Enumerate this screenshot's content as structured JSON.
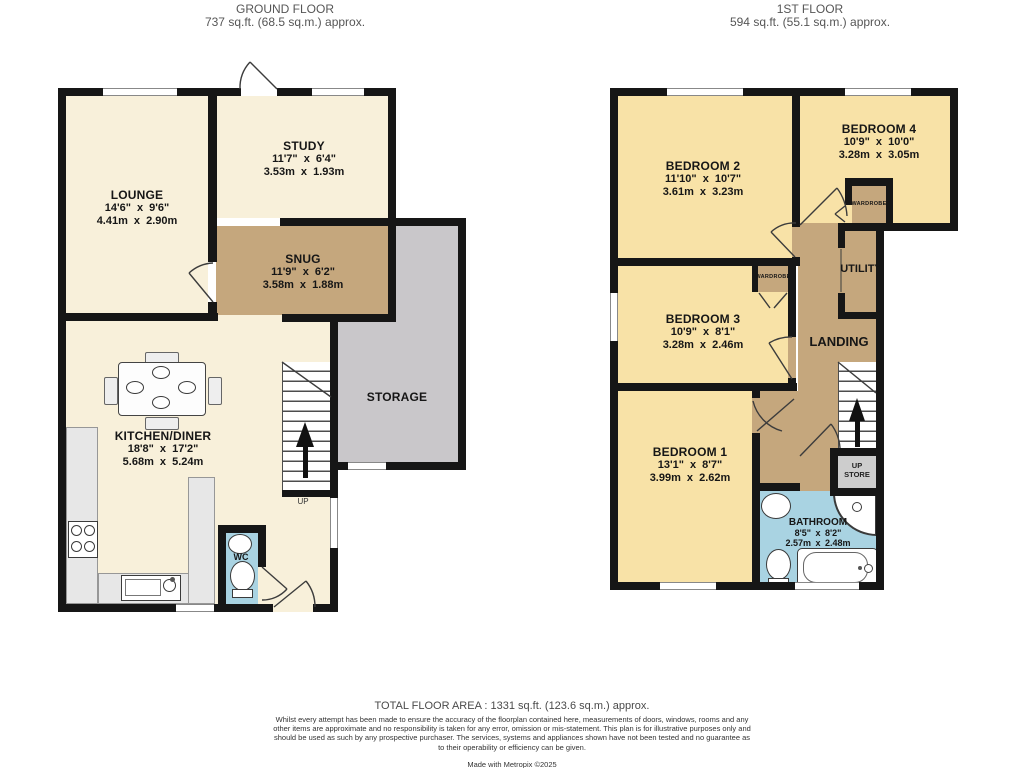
{
  "colors": {
    "wall": "#161616",
    "ground_room": "#f8f0da",
    "first_room": "#f8e2a7",
    "hallway": "#c5a77d",
    "storage": "#c9c7ca",
    "water": "#a9d3e2",
    "counter": "#e7e7e7",
    "store_box": "#cdcdcd"
  },
  "ground_floor": {
    "title": "GROUND FLOOR",
    "area": "737 sq.ft. (68.5 sq.m.) approx.",
    "rooms": {
      "lounge": {
        "name": "LOUNGE",
        "imperial": "14'6\" x 9'6\"",
        "metric": "4.41m x 2.90m"
      },
      "study": {
        "name": "STUDY",
        "imperial": "11'7\" x 6'4\"",
        "metric": "3.53m x 1.93m"
      },
      "snug": {
        "name": "SNUG",
        "imperial": "11'9\" x 6'2\"",
        "metric": "3.58m x 1.88m"
      },
      "kitchen_diner": {
        "name": "KITCHEN/DINER",
        "imperial": "18'8\" x 17'2\"",
        "metric": "5.68m x 5.24m"
      },
      "storage": {
        "name": "STORAGE"
      },
      "wc": {
        "name": "WC"
      }
    },
    "stairs_label": "UP"
  },
  "first_floor": {
    "title": "1ST FLOOR",
    "area": "594 sq.ft. (55.1 sq.m.) approx.",
    "rooms": {
      "bedroom_2": {
        "name": "BEDROOM 2",
        "imperial": "11'10\" x 10'7\"",
        "metric": "3.61m x 3.23m"
      },
      "bedroom_4": {
        "name": "BEDROOM 4",
        "imperial": "10'9\" x 10'0\"",
        "metric": "3.28m x 3.05m"
      },
      "bedroom_3": {
        "name": "BEDROOM 3",
        "imperial": "10'9\" x 8'1\"",
        "metric": "3.28m x 2.46m"
      },
      "bedroom_1": {
        "name": "BEDROOM 1",
        "imperial": "13'1\" x 8'7\"",
        "metric": "3.99m x 2.62m"
      },
      "bathroom": {
        "name": "BATHROOM",
        "imperial": "8'5\" x 8'2\"",
        "metric": "2.57m x 2.48m"
      },
      "landing": {
        "name": "LANDING"
      },
      "utility": {
        "name": "UTILITY"
      },
      "wardrobe_bedroom_4": {
        "name": "WARDROBE"
      },
      "wardrobe_bedroom_3": {
        "name": "WARDROBE"
      },
      "up_store": {
        "line1": "UP",
        "line2": "STORE"
      }
    }
  },
  "footer": {
    "total_area": "TOTAL FLOOR AREA : 1331 sq.ft. (123.6 sq.m.) approx.",
    "disclaimer": "Whilst every attempt has been made to ensure the accuracy of the floorplan contained here, measurements of doors, windows, rooms and any other items are approximate and no responsibility is taken for any error, omission or mis-statement. This plan is for illustrative purposes only and should be used as such by any prospective purchaser. The services, systems and appliances shown have not been tested and no guarantee as to their operability or efficiency can be given.",
    "credit": "Made with Metropix ©2025"
  }
}
